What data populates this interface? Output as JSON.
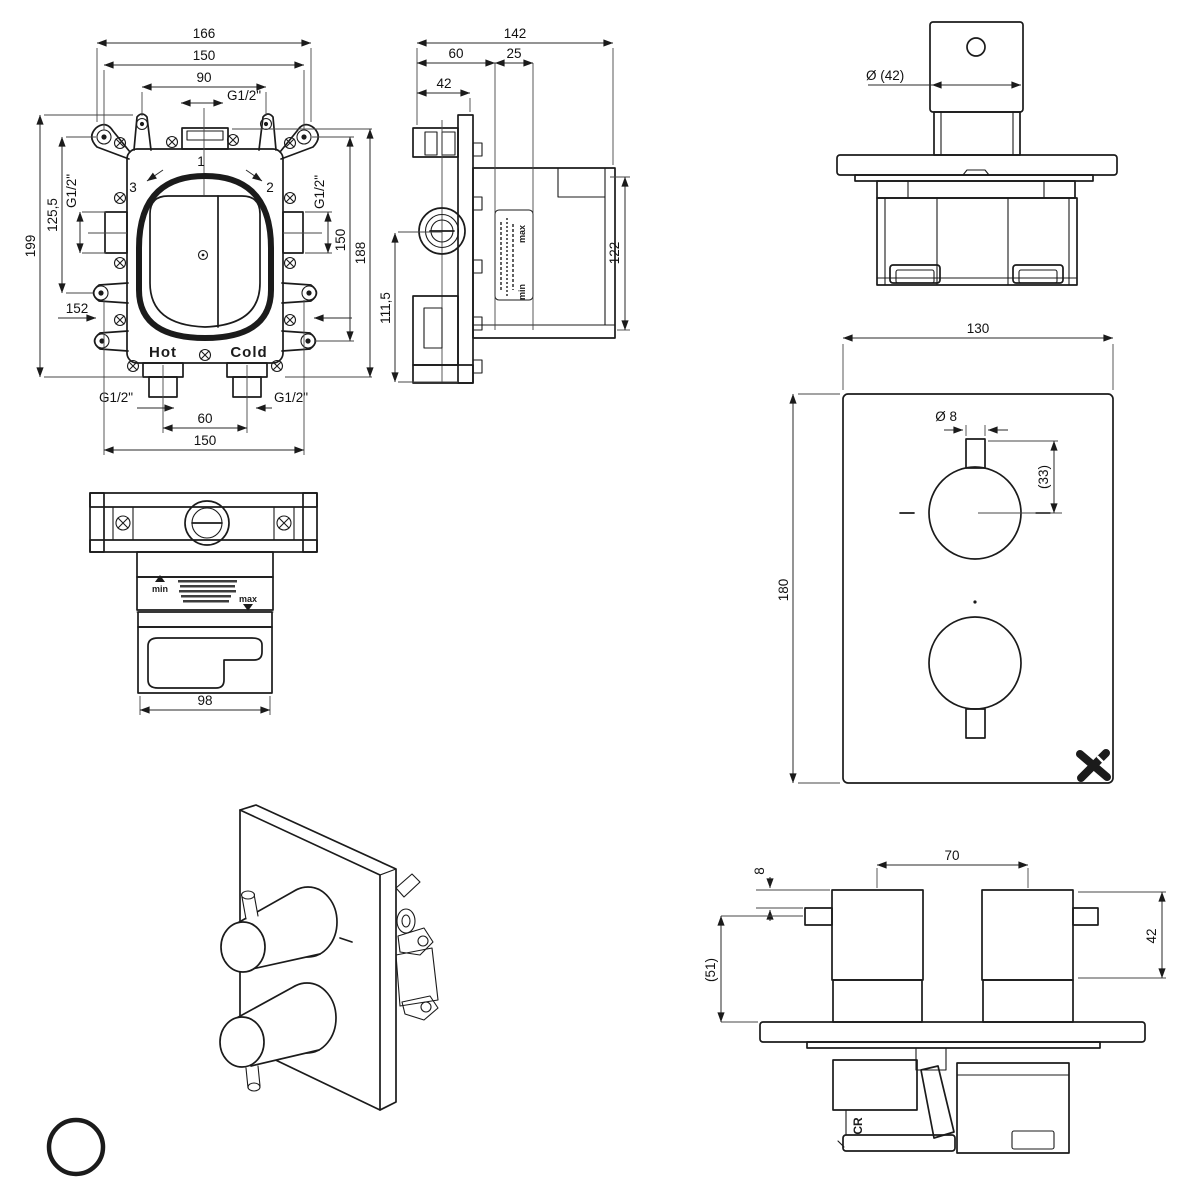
{
  "drawing": {
    "front_view": {
      "dim_overall_width": "166",
      "dim_mount_width": "150",
      "dim_bracket_holes": "90",
      "label_top_port": "G1/2\"",
      "label_outlet_top": "1",
      "label_outlet_right": "2",
      "label_outlet_left": "3",
      "label_side_port_left": "G1/2\"",
      "label_side_port_right": "G1/2\"",
      "dim_mount_height": "125,5",
      "dim_overall_height": "199",
      "dim_lower_holes": "152",
      "dim_right_mount": "150",
      "dim_right_overall": "188",
      "label_hot": "Hot",
      "label_cold": "Cold",
      "label_bottom_port_left": "G1/2\"",
      "label_bottom_port_right": "G1/2\"",
      "dim_port_spacing": "60",
      "dim_bottom_mount": "150"
    },
    "side_view": {
      "dim_overall_depth": "142",
      "dim_front_depth": "60",
      "dim_adjust_range": "25",
      "dim_bracket_depth": "42",
      "dim_body_height": "122",
      "dim_lower_height": "111,5",
      "label_min": "min",
      "label_max": "max"
    },
    "trim_side_view": {
      "dim_handle_dia": "Ø (42)"
    },
    "trim_front_view": {
      "dim_plate_width": "130",
      "dim_plate_height": "180",
      "dim_lever_dia": "Ø 8",
      "dim_lever_length": "(33)"
    },
    "plan_view": {
      "dim_body_width": "98",
      "label_min": "min",
      "label_max": "max"
    },
    "trim_top_view": {
      "dim_handle_spacing": "70",
      "dim_lever_offset": "8",
      "dim_handle_depth": "42",
      "dim_overall_depth": "(51)",
      "label_logo": "CR"
    }
  }
}
